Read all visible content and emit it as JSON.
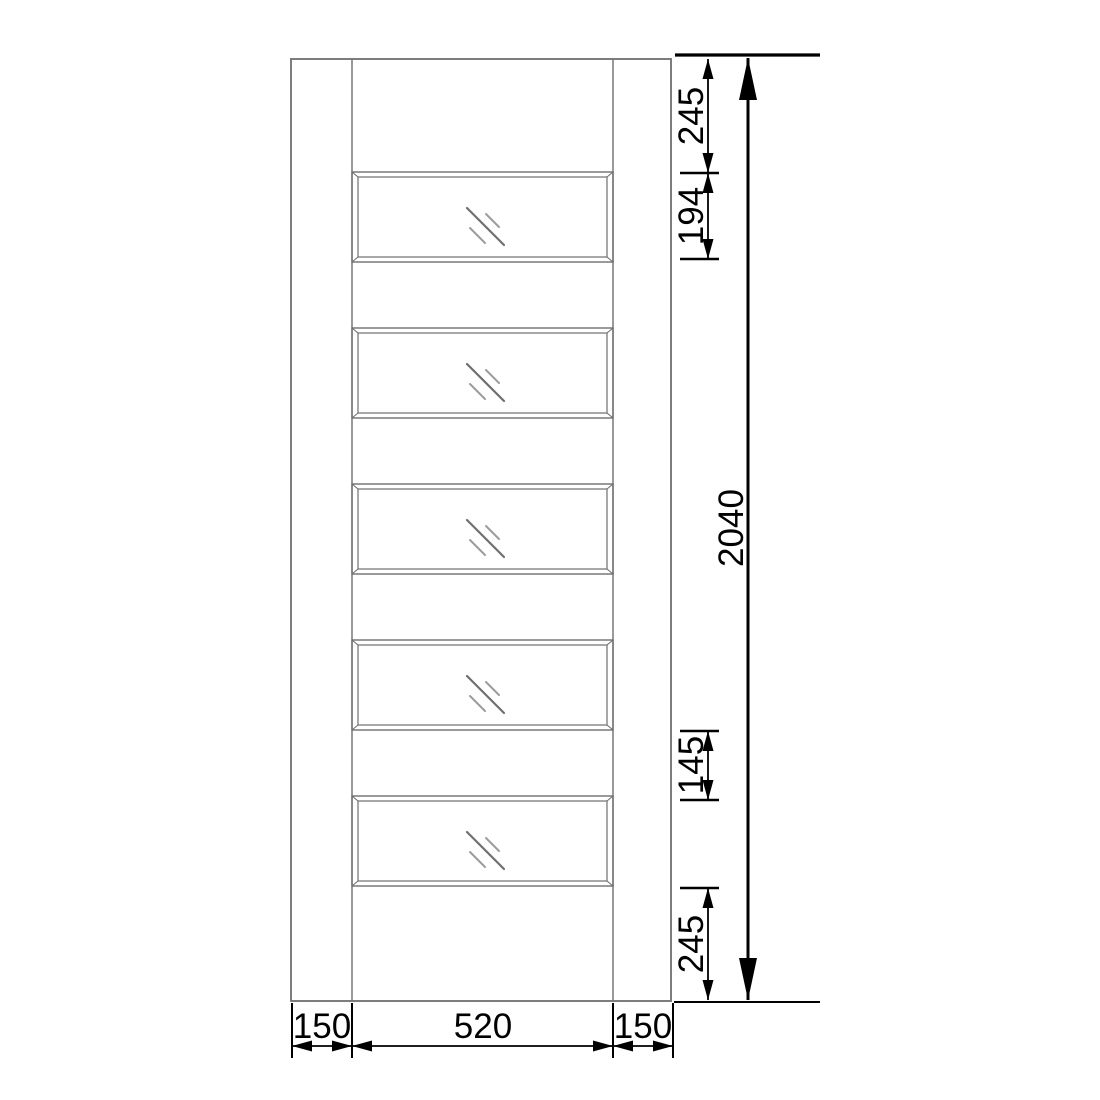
{
  "diagram": {
    "kind": "door-elevation-technical-drawing",
    "units": "mm",
    "glazed_panel_count": 5,
    "door_spec": {
      "overall_height": "2040",
      "top_rail": "245",
      "glazed_panel_height": "194",
      "rail_between_panels": "145",
      "bottom_rail": "245",
      "left_stile": "150",
      "glazing_width": "520",
      "right_stile": "150"
    },
    "colors": {
      "door_line": "#6f6f6f",
      "glass_mark_dark": "#6f6f6f",
      "glass_mark_light": "#9c9c9c",
      "dimension_line": "#000000",
      "background": "#ffffff"
    },
    "icons": {
      "glass_mark": "glazing-diagonal-slashes-icon"
    }
  },
  "dims": {
    "top_rail": "245",
    "panel_height": "194",
    "total_height": "2040",
    "panel_gap": "145",
    "bottom_rail": "245",
    "left_stile": "150",
    "panel_width": "520",
    "right_stile": "150"
  }
}
